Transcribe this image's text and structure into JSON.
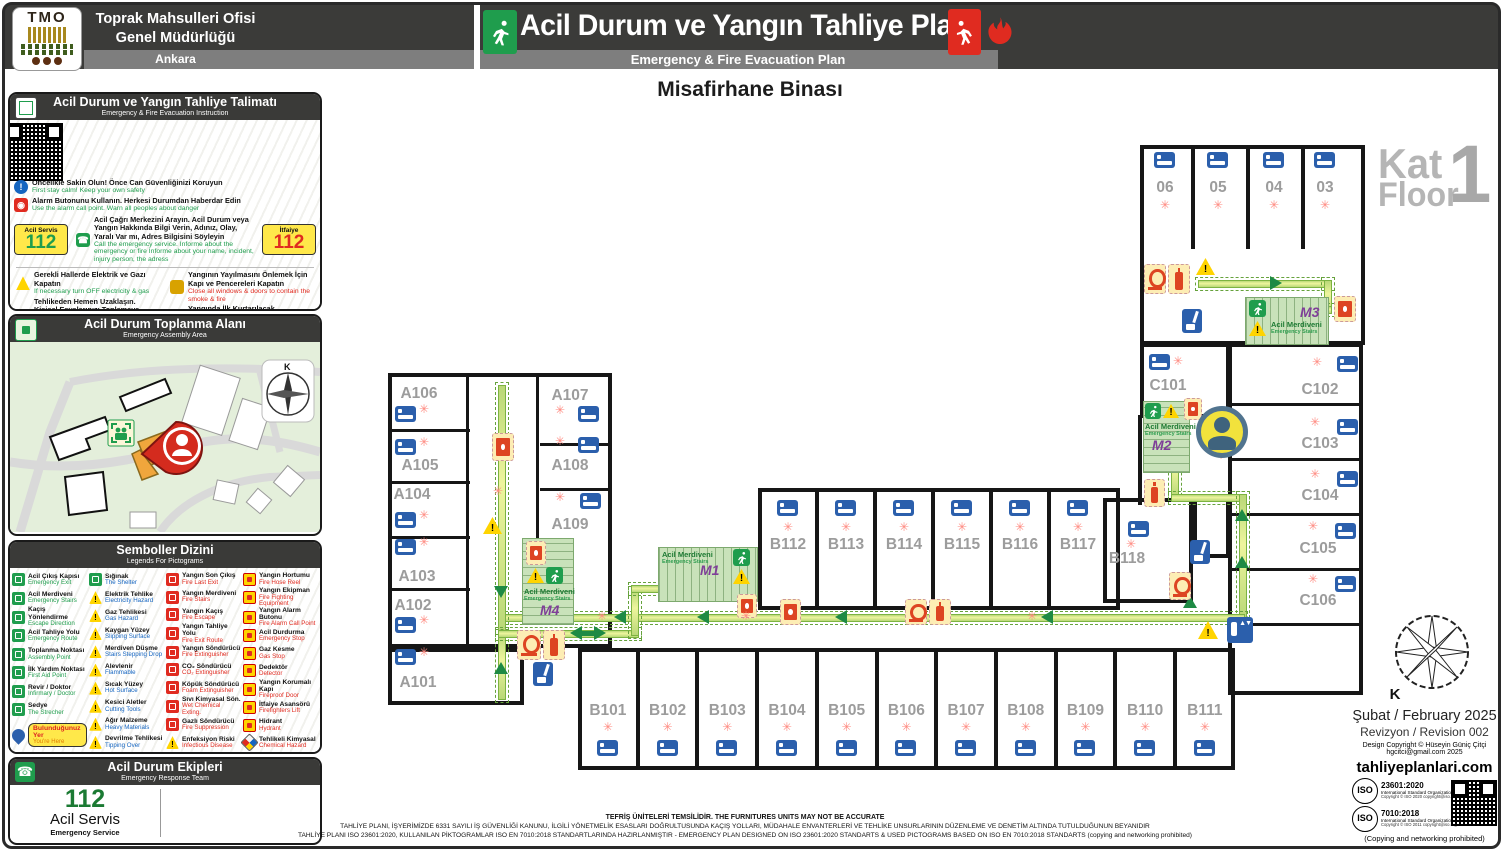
{
  "colors": {
    "wall": "#161616",
    "route_green": "#7cb342",
    "arrow_green": "#1e8a44",
    "stair_fill": "#c9e2ba",
    "exit_green": "#1f9d4d",
    "fire_red": "#e02b20",
    "warn_yellow": "#ffd400",
    "bed_blue": "#2b5fac",
    "m_purple": "#7f3f98",
    "label_gray": "#9c9c9c"
  },
  "header": {
    "logo_text": "TMO",
    "org_line1": "Toprak Mahsulleri Ofisi",
    "org_line2": "Genel Müdürlüğü",
    "city": "Ankara",
    "title_tr": "Acil Durum ve Yangın Tahliye Planı",
    "title_en": "Emergency & Fire Evacuation Plan"
  },
  "building_title": "Misafirhane Binası",
  "floor_badge": {
    "kat": "Kat",
    "floor": "Floor",
    "number": "1"
  },
  "instructions": {
    "title_tr": "Acil Durum ve Yangın Tahliye Talimatı",
    "title_en": "Emergency & Fire Evacuation Instruction",
    "badge_left": {
      "label": "Acil Servis",
      "number": "112"
    },
    "badge_right": {
      "label": "İtfaiye",
      "number": "112"
    },
    "steps_full": [
      {
        "icon": "info",
        "tr": "Öncelikle Sakin Olun! Önce Can Güvenliğinizi Koruyun",
        "en": "First stay calm! Keep your own safety"
      },
      {
        "icon": "alarm",
        "tr": "Alarm Butonunu Kullanın. Herkesi Durumdan Haberdar Edin",
        "en": "Use the alarm call point. Warn all peoples about danger"
      },
      {
        "icon": "phone",
        "tr": "Acil Çağrı Merkezini Arayın. Acil Durum veya Yangın Hakkında Bilgi Verin, Adınız, Olay, Yaralı Var mı, Adres Bilgisini Söyleyin",
        "en": "Call the emergency service. Informe about the emergency or fire Informe about your name, incident, injury person, the adress"
      }
    ],
    "steps_left": [
      {
        "icon": "warn",
        "tr": "Gerekli Hallerde Elektrik ve Gazı Kapatın",
        "en": "If necessary turn OFF electricity & gas"
      },
      {
        "icon": "info",
        "tr": "Tehlikeden Hemen Uzaklaşın. Kişisel Eşyalarınızı Toplamaya Çalışmayın Zaman Kaybetmeyin",
        "en": "Move away from any danger. DO NOT stop to collect personal belongings"
      },
      {
        "icon": "exit-green",
        "tr": "Emniyetli Yere Gidin. Güvenli Kaçış Yollarını Kullanın Acil Çıkış İşaretlerini Takip Edin.",
        "en": "Move to safety, use emergency exit routes Follows emergency exit routes signs",
        "arrows": "green"
      }
    ],
    "steps_right": [
      {
        "icon": "door",
        "tr": "Yangının Yayılmasını Önlemek İçin Kapı ve Pencereleri Kapatın",
        "en": "Close all windows & doors to contain the smoke & fire"
      },
      {
        "icon": "rescue",
        "tr": "Yangında İlk Kurtarılacak Malzemenizi Yanınıza Alın",
        "en": "Take with you first materials to be rescued in fire"
      },
      {
        "icon": "plan",
        "tr": "Acil Durum ve Yangın Tahliye Planına Uygun Şekilde Terk Edin",
        "en": "Leave building according emergency & fire evacuation floor plan"
      },
      {
        "icon": "exit-red",
        "tr": "Yangında, Yangın Korumalı Kaçış Yollarını Kullanın",
        "en": "In case of fire, use fire protected exit route",
        "arrows": "red"
      },
      {
        "icon": "crawl",
        "tr": "Duman Çoksa, Eğilerek Çıkışa Gidin, Temiz Hava Yere Yakındır",
        "en": "If the smoke is heavy, stay close to the ground"
      }
    ],
    "steps_bottom": [
      {
        "icon": "no-lift",
        "tr": "Asansörü Kullanmayın",
        "en": "DO NOT Use the lifts"
      },
      {
        "icon": "no-entry",
        "tr": "Yetkililer Hariç Kimseyi Binaya Yaklaştırmayın",
        "en": "DO NOT Allow People To Enter The Building"
      }
    ],
    "step_final": {
      "icon": "assembly",
      "tr": "Acil Toplanma Alanına Gidin",
      "en": "Proceed directly to your assembly point"
    }
  },
  "assembly": {
    "title_tr": "Acil Durum Toplanma Alanı",
    "title_en": "Emergency Assembly Area",
    "compass_label": "K"
  },
  "legend": {
    "title_tr": "Semboller Dizini",
    "title_en": "Legends For Pictograms",
    "col1": [
      {
        "tr": "Acil Çıkış Kapısı",
        "en": "Emergency Exit",
        "icon": "green"
      },
      {
        "tr": "Acil Merdiveni",
        "en": "Emergency Stairs",
        "icon": "green"
      },
      {
        "tr": "Kaçış Yönlendirme",
        "en": "Escape Direction",
        "icon": "green"
      },
      {
        "tr": "Acil Tahliye Yolu",
        "en": "Emergency Route",
        "icon": "green"
      },
      {
        "tr": "Toplanma Noktası",
        "en": "Assembly Point",
        "icon": "green"
      },
      {
        "tr": "İlk Yardım Noktası",
        "en": "First Aid Point",
        "icon": "green"
      },
      {
        "tr": "Revir / Doktor",
        "en": "Infirmary / Doctor",
        "icon": "green"
      },
      {
        "tr": "Sedye",
        "en": "The Strecher",
        "icon": "green"
      }
    ],
    "you_here": {
      "tr": "Bulunduğunuz Yer",
      "en": "You're Here",
      "icon": "pin"
    },
    "col2": [
      {
        "tr": "Sığınak",
        "en": "The Shelter",
        "icon": "green"
      },
      {
        "tr": "Elektrik Tehlike",
        "en": "Electricity Hazard",
        "icon": "warn"
      },
      {
        "tr": "Gaz Tehlikesi",
        "en": "Gas Hazard",
        "icon": "warn"
      },
      {
        "tr": "Kaygan Yüzey",
        "en": "Slipping Surface",
        "icon": "warn"
      },
      {
        "tr": "Merdiven Düşme",
        "en": "Stairs Stepping Drop",
        "icon": "warn"
      },
      {
        "tr": "Alevlenir",
        "en": "Flammable",
        "icon": "warn"
      },
      {
        "tr": "Sıcak Yüzey",
        "en": "Hot Surface",
        "icon": "warn"
      },
      {
        "tr": "Kesici Aletler",
        "en": "Cutting Tools",
        "icon": "warn"
      },
      {
        "tr": "Ağır Malzeme",
        "en": "Heavy Materials",
        "icon": "warn"
      },
      {
        "tr": "Devrilme Tehlikesi",
        "en": "Tipping Over",
        "icon": "warn"
      }
    ],
    "col3": [
      {
        "tr": "Yangın Son Çıkış",
        "en": "Fire Last Exit",
        "icon": "red"
      },
      {
        "tr": "Yangın Merdiveni",
        "en": "Fire Stairs",
        "icon": "red"
      },
      {
        "tr": "Yangın Kaçış",
        "en": "Fire Escape",
        "icon": "red"
      },
      {
        "tr": "Yangın Tahliye Yolu",
        "en": "Fire Exit Route",
        "icon": "red"
      },
      {
        "tr": "Yangın Söndürücü",
        "en": "Fire Extinguisher",
        "icon": "red"
      },
      {
        "tr": "CO₂ Söndürücü",
        "en": "CO₂ Extinguisher",
        "icon": "red"
      },
      {
        "tr": "Köpük Söndürücü",
        "en": "Foam Extinguisher",
        "icon": "red"
      },
      {
        "tr": "Sıvı Kimyasal Sön.",
        "en": "Wet Chemical Exting.",
        "icon": "red"
      },
      {
        "tr": "Gazlı Söndürücü",
        "en": "Fire Suppression",
        "icon": "red"
      },
      {
        "tr": "Enfeksiyon Riski",
        "en": "Infectious Disease",
        "icon": "warn"
      }
    ],
    "col4": [
      {
        "tr": "Yangın Hortumu",
        "en": "Fire Hose Reel",
        "icon": "yr"
      },
      {
        "tr": "Yangın Ekipman",
        "en": "Fire Fighting Equipment",
        "icon": "yr"
      },
      {
        "tr": "Yangın Alarm Butonu",
        "en": "Fire Alarm Call Point",
        "icon": "yr"
      },
      {
        "tr": "Acil Durdurma",
        "en": "Emergency Stop",
        "icon": "yr"
      },
      {
        "tr": "Gaz Kesme",
        "en": "Gas Stop",
        "icon": "yr"
      },
      {
        "tr": "Dedektör",
        "en": "Detector",
        "icon": "yr"
      },
      {
        "tr": "Yangın Korumalı Kapı",
        "en": "Fireproof Door",
        "icon": "yr"
      },
      {
        "tr": "İtfaiye Asansörü",
        "en": "Firefighters Lift",
        "icon": "yr"
      },
      {
        "tr": "Hidrant",
        "en": "Hydrant",
        "icon": "yr"
      },
      {
        "tr": "Tehlikeli Kimyasal",
        "en": "Chemical Hazard",
        "icon": "chem"
      }
    ]
  },
  "team": {
    "title_tr": "Acil Durum Ekipleri",
    "title_en": "Emergency Response Team",
    "phone_badge": "112",
    "number": "112",
    "label_tr": "Acil Servis",
    "label_en": "Emergency Service"
  },
  "plan": {
    "stair_label_tr": "Acil Merdiveni",
    "stair_label_en": "Emergency Stairs",
    "stairs": [
      "M1",
      "M2",
      "M3",
      "M4"
    ],
    "rooms_top": [
      "06",
      "05",
      "04",
      "03"
    ],
    "rooms_a": [
      "A101",
      "A102",
      "A103",
      "A104",
      "A105",
      "A106",
      "A107",
      "A108",
      "A109"
    ],
    "rooms_b_mid": [
      "B112",
      "B113",
      "B114",
      "B115",
      "B116",
      "B117",
      "B118"
    ],
    "rooms_b_bottom": [
      "B101",
      "B102",
      "B103",
      "B104",
      "B105",
      "B106",
      "B107",
      "B108",
      "B109",
      "B110",
      "B111"
    ],
    "rooms_c": [
      "C101",
      "C102",
      "C103",
      "C104",
      "C105",
      "C106"
    ]
  },
  "meta": {
    "compass_label": "K",
    "date": "Şubat / February 2025",
    "revision": "Revizyon / Revision 002",
    "copyright1": "Design Copyright © Hüseyin Güniç Çitçi",
    "copyright2": "hgcitci@gmail.com 2025",
    "website": "tahliyeplanlari.com",
    "iso1_code": "23601:2020",
    "iso1_org": "International Standard Organization (ISO)",
    "iso1_copy": "Copyright © ISO 2020 copyright@iso.org",
    "iso2_code": "7010:2018",
    "iso2_org": "International Standard Organization (ISO)",
    "iso2_copy": "Copyright © ISO 2011 copyright@iso.org",
    "prohibited": "(Copying and networking prohibited)"
  },
  "footer": {
    "line1": "TEFRİŞ ÜNİTELERİ TEMSİLİDİR. THE FURNITURES UNITS MAY NOT BE ACCURATE",
    "line2": "TAHLİYE PLANI, İŞYERİMİZDE 6331 SAYILI İŞ GÜVENLİĞİ KANUNU, İLGİLİ YÖNETMELİK ESASLARI DOĞRULTUSUNDA KAÇIŞ YOLLARI, MÜDAHALE ENVANTERLERİ VE TEHLİKE UNSURLARININ DÜZENLEME VE DENETİM ALTINDA TUTULDUĞUNUN BEYANIDIR",
    "line3": "TAHLİYE PLANI ISO 23601:2020, KULLANILAN PİKTOGRAMLAR ISO EN 7010:2018 STANDARTLARINDA HAZIRLANMIŞTIR - EMERGENCY PLAN DESIGNED ON ISO 23601:2020 STANDARTS & USED PICTOGRAMS BASED ON ISO EN 7010:2018 STANDARTS (copying and networking prohibited)"
  }
}
